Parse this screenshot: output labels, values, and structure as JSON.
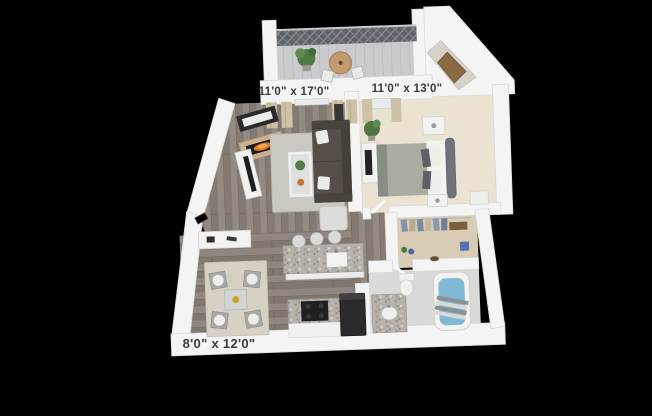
{
  "floorplan": {
    "dimension_labels": {
      "living_room": "11'0\" x 17'0\"",
      "bedroom": "11'0\" x 13'0\"",
      "dining_kitchen": "8'0\" x 12'0\""
    },
    "colors": {
      "background": "#000000",
      "walls": "#f4f4f4",
      "wood_floor": "#8a8279",
      "bedroom_carpet": "#ebe3d1",
      "closet_floor": "#d8cdb4",
      "granite_counter": "#b5b1aa",
      "tub_water": "#7fb9d6",
      "fireplace_flame": "#e0792a",
      "label_text": "#3a3a3a"
    }
  }
}
